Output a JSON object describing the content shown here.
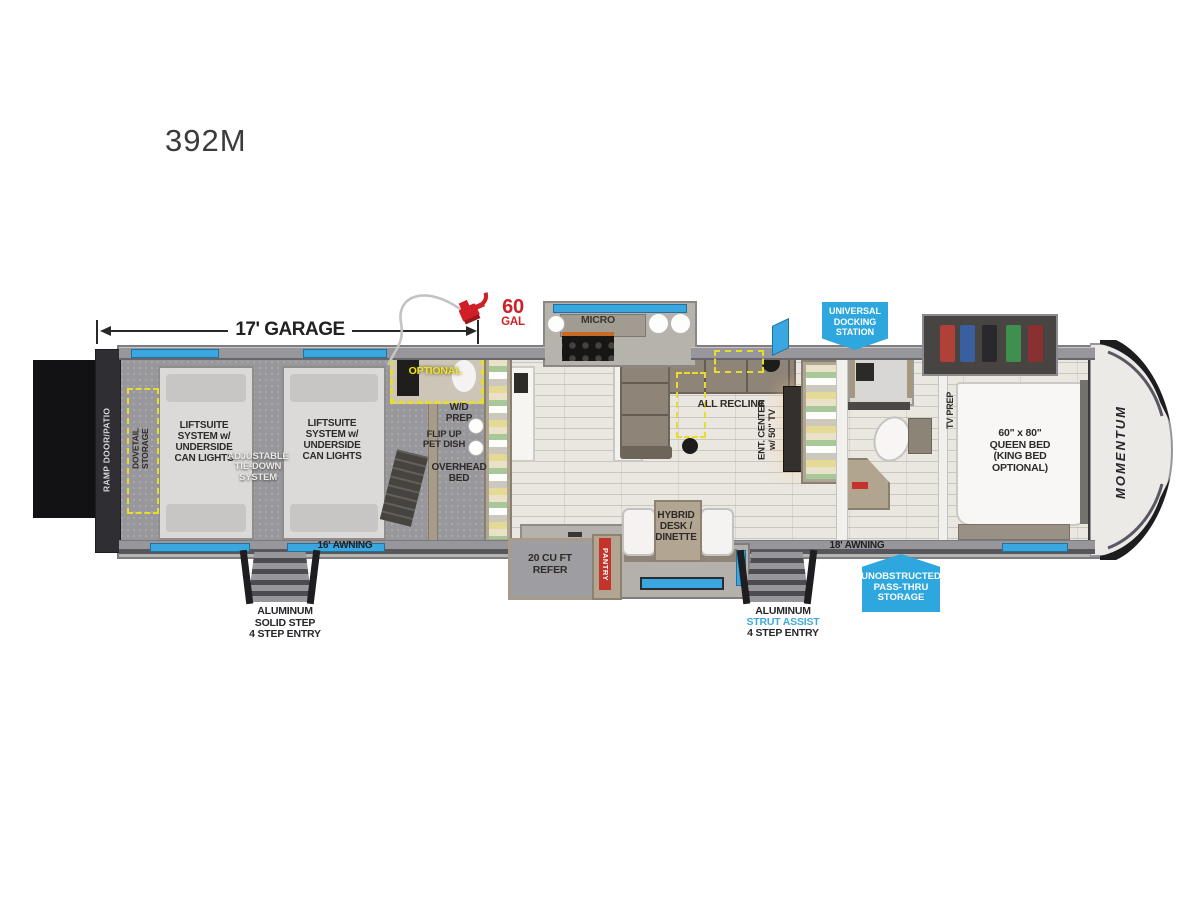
{
  "title": "392M",
  "annotations": {
    "garage_dimension": "17' GARAGE",
    "fuel_value": "60",
    "fuel_unit": "GAL"
  },
  "badges": {
    "docking": "UNIVERSAL\nDOCKING\nSTATION",
    "passthru": "UNOBSTRUCTED\nPASS-THRU\nSTORAGE"
  },
  "garage": {
    "ramp": "RAMP DOOR/PATIO",
    "dovetail": "DOVETAIL\nSTORAGE",
    "liftsuite_left": "LIFTSUITE\nSYSTEM w/\nUNDERSIDE\nCAN LIGHTS",
    "liftsuite_right": "LIFTSUITE\nSYSTEM w/\nUNDERSIDE\nCAN LIGHTS",
    "tiedown": "ADJUSTABLE\nTIE-DOWN\nSYSTEM",
    "optional": "OPTIONAL",
    "wd_prep": "W/D\nPREP",
    "pet_dish": "FLIP UP\nPET DISH",
    "overhead_bed": "OVERHEAD\nBED",
    "awning": "16' AWNING",
    "entry_step": "ALUMINUM\nSOLID STEP\n4 STEP ENTRY"
  },
  "living": {
    "micro": "MICRO",
    "all_recline": "ALL RECLINE",
    "ent_center": "ENT. CENTER\nw/ 50\" TV",
    "refer": "20 CU FT\nREFER",
    "pantry": "PANTRY",
    "dinette": "HYBRID\nDESK /\nDINETTE"
  },
  "bedroom": {
    "tv_prep": "TV PREP",
    "bed": "60\" x 80\"\nQUEEN BED\n(KING BED\nOPTIONAL)",
    "awning": "18' AWNING",
    "entry_step_line1": "ALUMINUM",
    "entry_step_line2": "STRUT ASSIST",
    "entry_step_line3": "4 STEP ENTRY",
    "logo": "MOMENTUM"
  },
  "colors": {
    "badge_blue": "#2da7dd",
    "accent_red": "#cf1f27",
    "dash_yellow": "#e8dd2c",
    "window_blue": "#3aa7e0",
    "strut_assist_blue": "#3fa9dc"
  }
}
